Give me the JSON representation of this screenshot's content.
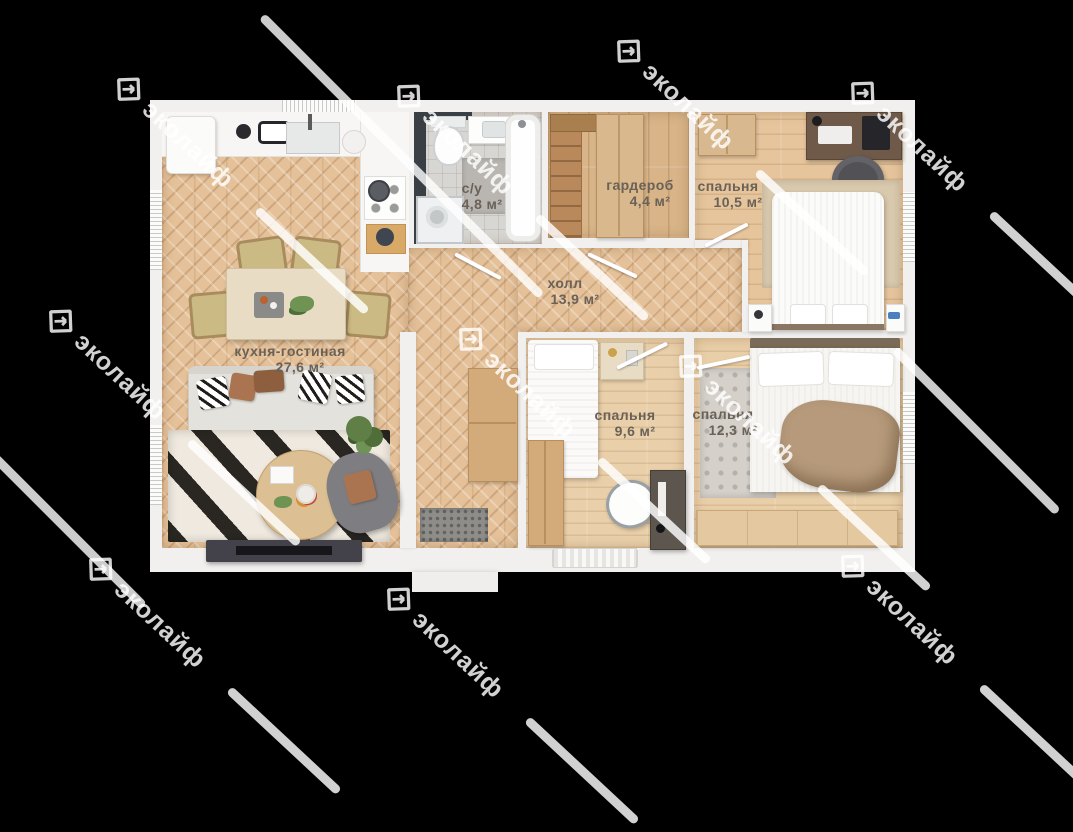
{
  "watermark": {
    "text": "эколайф"
  },
  "plan": {
    "rooms": [
      {
        "id": "kitchen-living",
        "name": "кухня-гостиная",
        "area": "27,6 м²"
      },
      {
        "id": "bathroom",
        "name": "с/у",
        "area": "4,8 м²"
      },
      {
        "id": "wardrobe",
        "name": "гардероб",
        "area": "4,4 м²"
      },
      {
        "id": "bedroom-top",
        "name": "спальня",
        "area": "10,5 м²"
      },
      {
        "id": "hall",
        "name": "холл",
        "area": "13,9 м²"
      },
      {
        "id": "bedroom-middle",
        "name": "спальня",
        "area": "9,6 м²"
      },
      {
        "id": "bedroom-right",
        "name": "спальня",
        "area": "12,3 м²"
      }
    ],
    "colors": {
      "background": "#000000",
      "walls": "#f1f0ee",
      "parquet": "#e5c199",
      "label_text": "#6a6157",
      "watermark": "rgba(255,255,255,0.82)"
    }
  }
}
